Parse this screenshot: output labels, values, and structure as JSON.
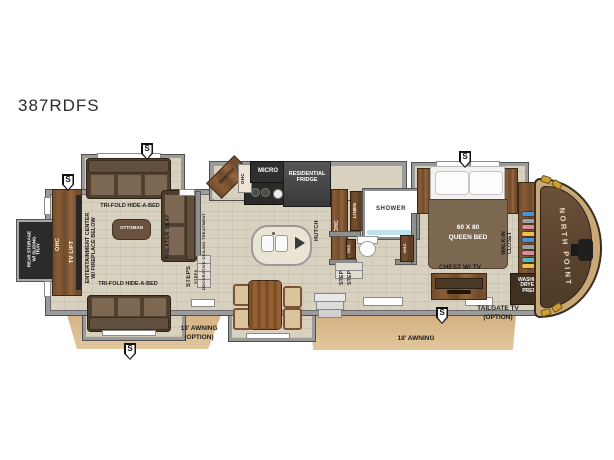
{
  "title": "387RDFS",
  "colors": {
    "awning": "#d9ba8c",
    "wall": "#8f8f8f",
    "floor": "#d8d1c0",
    "wood": "#7b5233",
    "front_cap": "#55402c",
    "dark_appliance": "#3c3c3c",
    "closet_items": [
      "#4a90d9",
      "#9aa0a8",
      "#d98ca0",
      "#e8c04a",
      "#50b8c8"
    ]
  },
  "plan": {
    "markers": [
      "S",
      "S",
      "S",
      "S",
      "S"
    ],
    "awnings": {
      "awning13_line1": "13' AWNING",
      "awning13_line2": "(OPTION)",
      "awning18": "18' AWNING"
    },
    "rear": {
      "storage_line1": "REAR STORAGE",
      "storage_line2": "W/ SLIDING",
      "storage_line3": "TRAY",
      "ohc": "OHC",
      "tv_lift": "TV LIFT",
      "ent_line1": "ENTERTAINMENT CENTER",
      "ent_line2": "W/ FIREPLACE BELOW"
    },
    "living": {
      "trifold_top": "TRI-FOLD HIDE-A-BED",
      "trifold_bottom": "TRI-FOLD HIDE-A-BED",
      "ottoman": "OTTOMAN",
      "theater_seat": "THEATER SEAT",
      "steps": "STEPS",
      "steps_small": "STEPS",
      "ceiling": "DECORATIVE CEILING TREATMENT"
    },
    "kitchen": {
      "pantry": "PANTRY",
      "ohc": "OHC",
      "micro": "MICRO",
      "fridge_line1": "RESIDENTIAL",
      "fridge_line2": "FRIDGE",
      "hutch": "HUTCH"
    },
    "bath": {
      "ohc_tall": "OHC",
      "linen": "LINEN",
      "shower": "SHOWER",
      "ohc_left": "OHC",
      "ohc_right": "OHC",
      "step1": "STEP",
      "step2": "STEP"
    },
    "bedroom": {
      "bed_line1": "60 X 80",
      "bed_line2": "QUEEN BED",
      "chest": "CHEST W/ TV",
      "walkin_line1": "WALK-IN",
      "walkin_line2": "CLOSET"
    },
    "front": {
      "washer_line1": "WASHER",
      "washer_line2": "DRYER",
      "washer_line3": "PREP",
      "brand": "NORTH POINT",
      "tailgate_line1": "TAILGATE TV",
      "tailgate_line2": "(OPTION)"
    }
  }
}
